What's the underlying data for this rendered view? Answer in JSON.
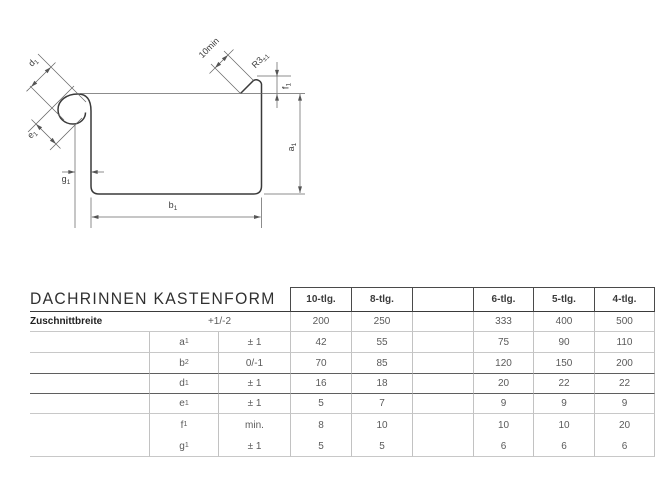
{
  "drawing": {
    "labels": {
      "d1": {
        "base": "d",
        "sub": "1"
      },
      "e1": {
        "base": "e",
        "sub": "1"
      },
      "g1": {
        "base": "g",
        "sub": "1"
      },
      "b1": {
        "base": "b",
        "sub": "1"
      },
      "a1": {
        "base": "a",
        "sub": "1"
      },
      "f1": {
        "base": "f",
        "sub": "1"
      },
      "flange_min": "10min",
      "radius": {
        "base": "R3",
        "sub": "±1"
      }
    },
    "colors": {
      "ink": "#3a3a3a",
      "thin": "#666666"
    }
  },
  "table": {
    "title": "DACHRINNEN KASTENFORM",
    "col_headers": [
      "10-tlg.",
      "8-tlg.",
      "",
      "6-tlg.",
      "5-tlg.",
      "4-tlg."
    ],
    "cut_row": {
      "label": "Zuschnittbreite",
      "tolerance": "+1/-2",
      "values": [
        "200",
        "250",
        "",
        "333",
        "400",
        "500"
      ]
    },
    "rows": [
      {
        "sym": "a",
        "sub": "1",
        "tol": "± 1",
        "values": [
          "42",
          "55",
          "",
          "75",
          "90",
          "110"
        ]
      },
      {
        "sym": "b",
        "sub": "2",
        "tol": "0/-1",
        "values": [
          "70",
          "85",
          "",
          "120",
          "150",
          "200"
        ]
      },
      {
        "sym": "d",
        "sub": "1",
        "tol": "± 1",
        "values": [
          "16",
          "18",
          "",
          "20",
          "22",
          "22"
        ]
      },
      {
        "sym": "e",
        "sub": "1",
        "tol": "± 1",
        "values": [
          "5",
          "7",
          "",
          "9",
          "9",
          "9"
        ]
      },
      {
        "sym": "f",
        "sub": "1",
        "tol": "min.",
        "values": [
          "8",
          "10",
          "",
          "10",
          "10",
          "20"
        ]
      },
      {
        "sym": "g",
        "sub": "1",
        "tol": "± 1",
        "values": [
          "5",
          "5",
          "",
          "6",
          "6",
          "6"
        ]
      }
    ],
    "colors": {
      "grid_light": "#c2c2c2",
      "grid_dark": "#5f5f5f"
    }
  }
}
